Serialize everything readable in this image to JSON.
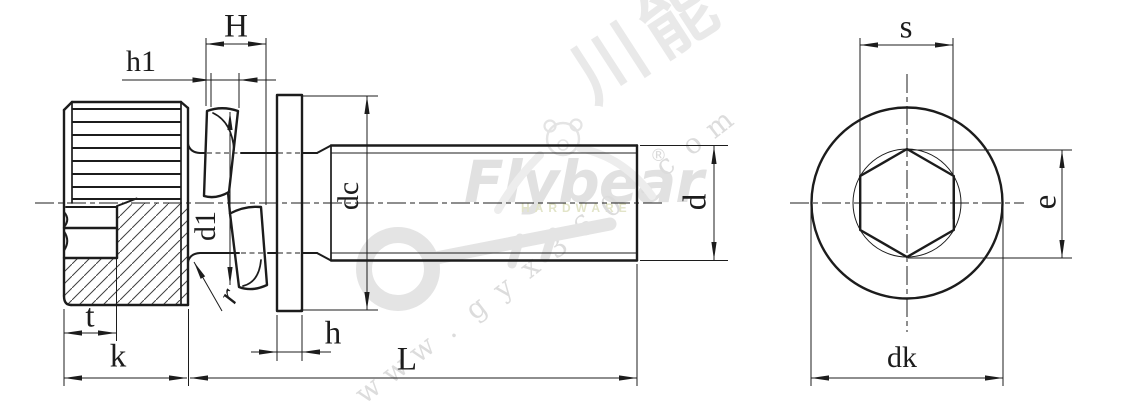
{
  "drawing": {
    "type": "engineering-drawing",
    "subject": "knurled socket head screw with captive spring washer and flat washer, side view and end view"
  },
  "labels": {
    "H": "H",
    "h1": "h1",
    "d1": "d1",
    "r": "r",
    "dc": "dc",
    "d": "d",
    "t": "t",
    "k": "k",
    "h": "h",
    "L": "L",
    "s": "s",
    "e": "e",
    "dk": "dk"
  },
  "watermark": {
    "brand": "Flybear",
    "sub": "HARDWARE",
    "reg": "®",
    "cjk": "川能",
    "url": "www.gyx360.com"
  },
  "colors": {
    "line": "#1c1c1c",
    "hatch": "#3f3f3f",
    "wm_gray": "#e4e4e4",
    "wm_soft": "#ededed",
    "wm_text": "#e1e1e1",
    "wm_khaki": "#e2e4c8",
    "wm_url": "#dcdcdc",
    "wm_cjk": "#e9e9e9"
  }
}
